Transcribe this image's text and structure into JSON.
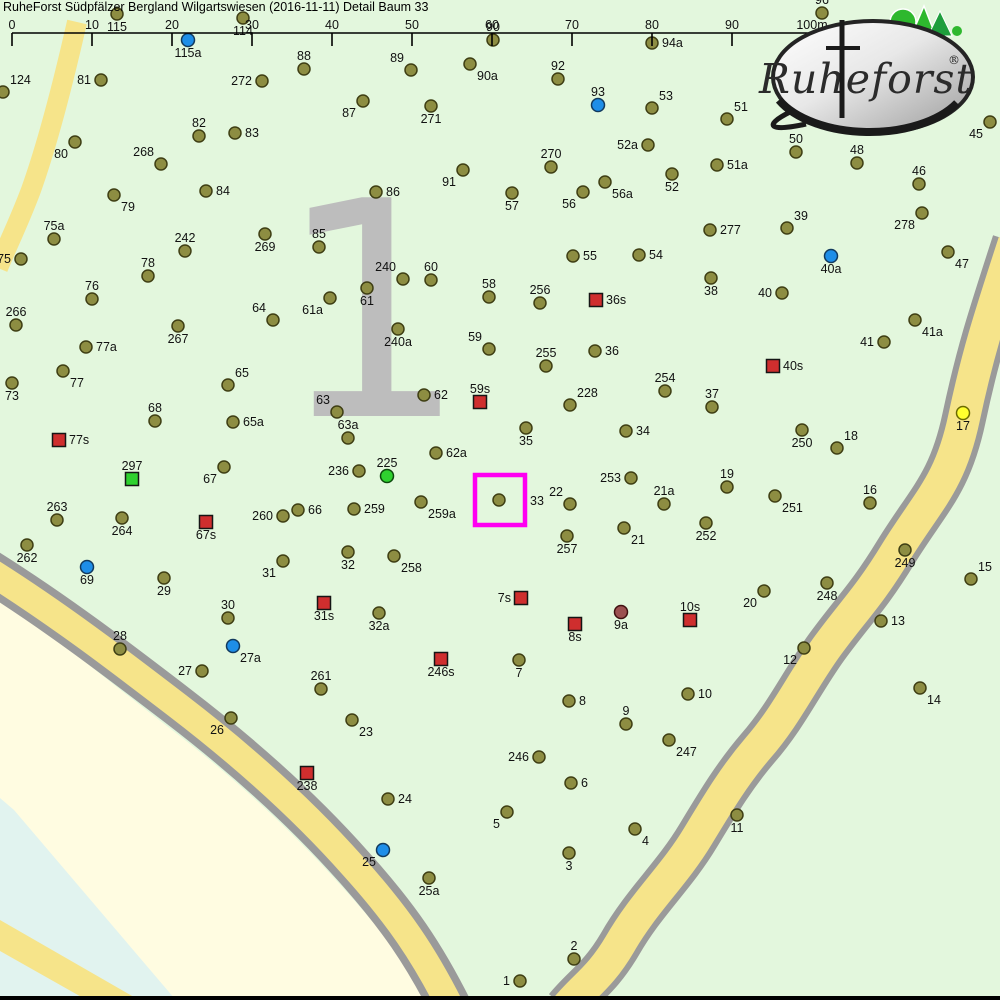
{
  "title": "RuheForst Südpfälzer Bergland Wilgartswiesen (2016-11-11) Detail  Baum 33",
  "logo": {
    "brand": "Ruheforst",
    "registered": "®"
  },
  "sector": {
    "label": "1"
  },
  "scale_bar": {
    "labels": [
      "0",
      "10",
      "20",
      "30",
      "40",
      "50",
      "60",
      "70",
      "80",
      "90",
      "100m"
    ],
    "tick_xs": [
      12,
      92,
      172,
      252,
      332,
      412,
      492,
      572,
      652,
      732,
      812
    ],
    "line_y": 33,
    "tick_bottom_y": 46,
    "label_y": 29
  },
  "highlight": {
    "for_point": "33",
    "x": 475,
    "y": 475,
    "size": 50,
    "color": "#ff00f2"
  },
  "colors": {
    "background": "#e3f7dd",
    "outside_area": "#fffce1",
    "water_band": "#e1f3ef",
    "road_fill": "#f6e48a",
    "road_border": "#9a9a9a",
    "sector_number": "#bdbdbd",
    "highlight": "#ff00f2",
    "tree": "#8d8d42",
    "tree_border": "#3f3f14",
    "blue": "#1e8ee8",
    "green": "#2fd12f",
    "yellow": "#ffff2e",
    "darkred": "#9c5050",
    "square_red": "#cf2e2e",
    "square_green": "#2fd12f",
    "label": "#111111"
  },
  "marker_kinds": {
    "t": "tree-olive-dot",
    "b": "blue-dot",
    "g": "green-dot",
    "y": "yellow-dot",
    "r": "darkred-dot",
    "sr": "red-square-marker",
    "sg": "green-square-marker"
  },
  "points": [
    {
      "n": "115",
      "x": 117,
      "y": 14,
      "k": "t",
      "p": "below"
    },
    {
      "n": "114",
      "x": 243,
      "y": 18,
      "k": "t",
      "p": "below"
    },
    {
      "n": "115a",
      "x": 188,
      "y": 40,
      "k": "b",
      "p": "below"
    },
    {
      "n": "96",
      "x": 822,
      "y": 13,
      "k": "t",
      "p": "above"
    },
    {
      "n": "94a",
      "x": 652,
      "y": 43,
      "k": "t",
      "p": "right"
    },
    {
      "n": "90",
      "x": 493,
      "y": 40,
      "k": "t",
      "p": "above"
    },
    {
      "n": "124",
      "x": 3,
      "y": 92,
      "k": "t",
      "p": "above-right"
    },
    {
      "n": "81",
      "x": 101,
      "y": 80,
      "k": "t",
      "p": "left"
    },
    {
      "n": "88",
      "x": 304,
      "y": 69,
      "k": "t",
      "p": "above"
    },
    {
      "n": "89",
      "x": 411,
      "y": 70,
      "k": "t",
      "p": "above-left"
    },
    {
      "n": "90a",
      "x": 470,
      "y": 64,
      "k": "t",
      "p": "below-right"
    },
    {
      "n": "272",
      "x": 262,
      "y": 81,
      "k": "t",
      "p": "left"
    },
    {
      "n": "92",
      "x": 558,
      "y": 79,
      "k": "t",
      "p": "above"
    },
    {
      "n": "93",
      "x": 598,
      "y": 105,
      "k": "b",
      "p": "above"
    },
    {
      "n": "53",
      "x": 652,
      "y": 108,
      "k": "t",
      "p": "above-right"
    },
    {
      "n": "51",
      "x": 727,
      "y": 119,
      "k": "t",
      "p": "above-right"
    },
    {
      "n": "82",
      "x": 199,
      "y": 136,
      "k": "t",
      "p": "above"
    },
    {
      "n": "83",
      "x": 235,
      "y": 133,
      "k": "t",
      "p": "right"
    },
    {
      "n": "80",
      "x": 75,
      "y": 142,
      "k": "t",
      "p": "below-left"
    },
    {
      "n": "268",
      "x": 161,
      "y": 164,
      "k": "t",
      "p": "above-left"
    },
    {
      "n": "87",
      "x": 363,
      "y": 101,
      "k": "t",
      "p": "below-left"
    },
    {
      "n": "271",
      "x": 431,
      "y": 106,
      "k": "t",
      "p": "below"
    },
    {
      "n": "270",
      "x": 551,
      "y": 167,
      "k": "t",
      "p": "above"
    },
    {
      "n": "52a",
      "x": 648,
      "y": 145,
      "k": "t",
      "p": "left"
    },
    {
      "n": "51a",
      "x": 717,
      "y": 165,
      "k": "t",
      "p": "right"
    },
    {
      "n": "52",
      "x": 672,
      "y": 174,
      "k": "t",
      "p": "below"
    },
    {
      "n": "45",
      "x": 990,
      "y": 122,
      "k": "t",
      "p": "below-left"
    },
    {
      "n": "50",
      "x": 796,
      "y": 152,
      "k": "t",
      "p": "above"
    },
    {
      "n": "48",
      "x": 857,
      "y": 163,
      "k": "t",
      "p": "above"
    },
    {
      "n": "46",
      "x": 919,
      "y": 184,
      "k": "t",
      "p": "above"
    },
    {
      "n": "84",
      "x": 206,
      "y": 191,
      "k": "t",
      "p": "right"
    },
    {
      "n": "79",
      "x": 114,
      "y": 195,
      "k": "t",
      "p": "below-right"
    },
    {
      "n": "91",
      "x": 463,
      "y": 170,
      "k": "t",
      "p": "below-left"
    },
    {
      "n": "86",
      "x": 376,
      "y": 192,
      "k": "t",
      "p": "right"
    },
    {
      "n": "56a",
      "x": 605,
      "y": 182,
      "k": "t",
      "p": "below-right"
    },
    {
      "n": "56",
      "x": 583,
      "y": 192,
      "k": "t",
      "p": "below-left"
    },
    {
      "n": "57",
      "x": 512,
      "y": 193,
      "k": "t",
      "p": "below"
    },
    {
      "n": "278",
      "x": 922,
      "y": 213,
      "k": "t",
      "p": "below-left"
    },
    {
      "n": "39",
      "x": 787,
      "y": 228,
      "k": "t",
      "p": "above-right"
    },
    {
      "n": "75a",
      "x": 54,
      "y": 239,
      "k": "t",
      "p": "above"
    },
    {
      "n": "242",
      "x": 185,
      "y": 251,
      "k": "t",
      "p": "above"
    },
    {
      "n": "85",
      "x": 319,
      "y": 247,
      "k": "t",
      "p": "above"
    },
    {
      "n": "269",
      "x": 265,
      "y": 234,
      "k": "t",
      "p": "below"
    },
    {
      "n": "75",
      "x": 21,
      "y": 259,
      "k": "t",
      "p": "left"
    },
    {
      "n": "277",
      "x": 710,
      "y": 230,
      "k": "t",
      "p": "right"
    },
    {
      "n": "55",
      "x": 573,
      "y": 256,
      "k": "t",
      "p": "right"
    },
    {
      "n": "54",
      "x": 639,
      "y": 255,
      "k": "t",
      "p": "right"
    },
    {
      "n": "47",
      "x": 948,
      "y": 252,
      "k": "t",
      "p": "below-right"
    },
    {
      "n": "40a",
      "x": 831,
      "y": 256,
      "k": "b",
      "p": "below"
    },
    {
      "n": "78",
      "x": 148,
      "y": 276,
      "k": "t",
      "p": "above"
    },
    {
      "n": "240",
      "x": 403,
      "y": 279,
      "k": "t",
      "p": "above-left"
    },
    {
      "n": "60",
      "x": 431,
      "y": 280,
      "k": "t",
      "p": "above"
    },
    {
      "n": "58",
      "x": 489,
      "y": 297,
      "k": "t",
      "p": "above"
    },
    {
      "n": "76",
      "x": 92,
      "y": 299,
      "k": "t",
      "p": "above"
    },
    {
      "n": "266",
      "x": 16,
      "y": 325,
      "k": "t",
      "p": "above"
    },
    {
      "n": "38",
      "x": 711,
      "y": 278,
      "k": "t",
      "p": "below"
    },
    {
      "n": "256",
      "x": 540,
      "y": 303,
      "k": "t",
      "p": "above"
    },
    {
      "n": "36s",
      "x": 596,
      "y": 300,
      "k": "sr",
      "p": "right"
    },
    {
      "n": "61",
      "x": 367,
      "y": 288,
      "k": "t",
      "p": "below"
    },
    {
      "n": "61a",
      "x": 330,
      "y": 298,
      "k": "t",
      "p": "below-left"
    },
    {
      "n": "64",
      "x": 273,
      "y": 320,
      "k": "t",
      "p": "above-left"
    },
    {
      "n": "40",
      "x": 782,
      "y": 293,
      "k": "t",
      "p": "left"
    },
    {
      "n": "267",
      "x": 178,
      "y": 326,
      "k": "t",
      "p": "below"
    },
    {
      "n": "77a",
      "x": 86,
      "y": 347,
      "k": "t",
      "p": "right"
    },
    {
      "n": "41a",
      "x": 915,
      "y": 320,
      "k": "t",
      "p": "below-right"
    },
    {
      "n": "41",
      "x": 884,
      "y": 342,
      "k": "t",
      "p": "left"
    },
    {
      "n": "240a",
      "x": 398,
      "y": 329,
      "k": "t",
      "p": "below"
    },
    {
      "n": "59",
      "x": 489,
      "y": 349,
      "k": "t",
      "p": "above-left"
    },
    {
      "n": "36",
      "x": 595,
      "y": 351,
      "k": "t",
      "p": "right"
    },
    {
      "n": "255",
      "x": 546,
      "y": 366,
      "k": "t",
      "p": "above"
    },
    {
      "n": "77",
      "x": 63,
      "y": 371,
      "k": "t",
      "p": "below-right"
    },
    {
      "n": "73",
      "x": 12,
      "y": 383,
      "k": "t",
      "p": "below"
    },
    {
      "n": "65",
      "x": 228,
      "y": 385,
      "k": "t",
      "p": "above-right"
    },
    {
      "n": "40s",
      "x": 773,
      "y": 366,
      "k": "sr",
      "p": "right"
    },
    {
      "n": "254",
      "x": 665,
      "y": 391,
      "k": "t",
      "p": "above"
    },
    {
      "n": "37",
      "x": 712,
      "y": 407,
      "k": "t",
      "p": "above"
    },
    {
      "n": "228",
      "x": 570,
      "y": 405,
      "k": "t",
      "p": "above-right"
    },
    {
      "n": "68",
      "x": 155,
      "y": 421,
      "k": "t",
      "p": "above"
    },
    {
      "n": "65a",
      "x": 233,
      "y": 422,
      "k": "t",
      "p": "right"
    },
    {
      "n": "62",
      "x": 424,
      "y": 395,
      "k": "t",
      "p": "right"
    },
    {
      "n": "59s",
      "x": 480,
      "y": 402,
      "k": "sr",
      "p": "above"
    },
    {
      "n": "63",
      "x": 337,
      "y": 412,
      "k": "t",
      "p": "above-left"
    },
    {
      "n": "17",
      "x": 963,
      "y": 413,
      "k": "y",
      "p": "below"
    },
    {
      "n": "63a",
      "x": 348,
      "y": 438,
      "k": "t",
      "p": "above"
    },
    {
      "n": "35",
      "x": 526,
      "y": 428,
      "k": "t",
      "p": "below"
    },
    {
      "n": "34",
      "x": 626,
      "y": 431,
      "k": "t",
      "p": "right"
    },
    {
      "n": "77s",
      "x": 59,
      "y": 440,
      "k": "sr",
      "p": "right"
    },
    {
      "n": "62a",
      "x": 436,
      "y": 453,
      "k": "t",
      "p": "right"
    },
    {
      "n": "250",
      "x": 802,
      "y": 430,
      "k": "t",
      "p": "below"
    },
    {
      "n": "18",
      "x": 837,
      "y": 448,
      "k": "t",
      "p": "above-right"
    },
    {
      "n": "297",
      "x": 132,
      "y": 479,
      "k": "sg",
      "p": "above"
    },
    {
      "n": "67",
      "x": 224,
      "y": 467,
      "k": "t",
      "p": "below-left"
    },
    {
      "n": "225",
      "x": 387,
      "y": 476,
      "k": "g",
      "p": "above"
    },
    {
      "n": "236",
      "x": 359,
      "y": 471,
      "k": "t",
      "p": "left"
    },
    {
      "n": "19",
      "x": 727,
      "y": 487,
      "k": "t",
      "p": "above"
    },
    {
      "n": "253",
      "x": 631,
      "y": 478,
      "k": "t",
      "p": "left"
    },
    {
      "n": "16",
      "x": 870,
      "y": 503,
      "k": "t",
      "p": "above"
    },
    {
      "n": "21a",
      "x": 664,
      "y": 504,
      "k": "t",
      "p": "above"
    },
    {
      "n": "33",
      "x": 499,
      "y": 500,
      "k": "t",
      "p": "right",
      "lx": 530,
      "ly": 505
    },
    {
      "n": "22",
      "x": 570,
      "y": 504,
      "k": "t",
      "p": "above-left"
    },
    {
      "n": "251",
      "x": 775,
      "y": 496,
      "k": "t",
      "p": "below-right"
    },
    {
      "n": "263",
      "x": 57,
      "y": 520,
      "k": "t",
      "p": "above"
    },
    {
      "n": "264",
      "x": 122,
      "y": 518,
      "k": "t",
      "p": "below"
    },
    {
      "n": "260",
      "x": 283,
      "y": 516,
      "k": "t",
      "p": "left"
    },
    {
      "n": "66",
      "x": 298,
      "y": 510,
      "k": "t",
      "p": "right"
    },
    {
      "n": "259",
      "x": 354,
      "y": 509,
      "k": "t",
      "p": "right"
    },
    {
      "n": "259a",
      "x": 421,
      "y": 502,
      "k": "t",
      "p": "below-right"
    },
    {
      "n": "67s",
      "x": 206,
      "y": 522,
      "k": "sr",
      "p": "below"
    },
    {
      "n": "21",
      "x": 624,
      "y": 528,
      "k": "t",
      "p": "below-right"
    },
    {
      "n": "252",
      "x": 706,
      "y": 523,
      "k": "t",
      "p": "below"
    },
    {
      "n": "257",
      "x": 567,
      "y": 536,
      "k": "t",
      "p": "below"
    },
    {
      "n": "31",
      "x": 283,
      "y": 561,
      "k": "t",
      "p": "below-left"
    },
    {
      "n": "32",
      "x": 348,
      "y": 552,
      "k": "t",
      "p": "below"
    },
    {
      "n": "258",
      "x": 394,
      "y": 556,
      "k": "t",
      "p": "below-right"
    },
    {
      "n": "262",
      "x": 27,
      "y": 545,
      "k": "t",
      "p": "below"
    },
    {
      "n": "69",
      "x": 87,
      "y": 567,
      "k": "b",
      "p": "below"
    },
    {
      "n": "29",
      "x": 164,
      "y": 578,
      "k": "t",
      "p": "below"
    },
    {
      "n": "249",
      "x": 905,
      "y": 550,
      "k": "t",
      "p": "below"
    },
    {
      "n": "15",
      "x": 971,
      "y": 579,
      "k": "t",
      "p": "above-right"
    },
    {
      "n": "248",
      "x": 827,
      "y": 583,
      "k": "t",
      "p": "below"
    },
    {
      "n": "20",
      "x": 764,
      "y": 591,
      "k": "t",
      "p": "below-left"
    },
    {
      "n": "30",
      "x": 228,
      "y": 618,
      "k": "t",
      "p": "above"
    },
    {
      "n": "7s",
      "x": 521,
      "y": 598,
      "k": "sr",
      "p": "left"
    },
    {
      "n": "31s",
      "x": 324,
      "y": 603,
      "k": "sr",
      "p": "below"
    },
    {
      "n": "32a",
      "x": 379,
      "y": 613,
      "k": "t",
      "p": "below"
    },
    {
      "n": "10s",
      "x": 690,
      "y": 620,
      "k": "sr",
      "p": "above"
    },
    {
      "n": "9a",
      "x": 621,
      "y": 612,
      "k": "r",
      "p": "below"
    },
    {
      "n": "8s",
      "x": 575,
      "y": 624,
      "k": "sr",
      "p": "below"
    },
    {
      "n": "13",
      "x": 881,
      "y": 621,
      "k": "t",
      "p": "right"
    },
    {
      "n": "28",
      "x": 120,
      "y": 649,
      "k": "t",
      "p": "above"
    },
    {
      "n": "27a",
      "x": 233,
      "y": 646,
      "k": "b",
      "p": "below-right"
    },
    {
      "n": "12",
      "x": 804,
      "y": 648,
      "k": "t",
      "p": "below-left"
    },
    {
      "n": "7",
      "x": 519,
      "y": 660,
      "k": "t",
      "p": "below"
    },
    {
      "n": "27",
      "x": 202,
      "y": 671,
      "k": "t",
      "p": "left"
    },
    {
      "n": "246s",
      "x": 441,
      "y": 659,
      "k": "sr",
      "p": "below"
    },
    {
      "n": "261",
      "x": 321,
      "y": 689,
      "k": "t",
      "p": "above"
    },
    {
      "n": "14",
      "x": 920,
      "y": 688,
      "k": "t",
      "p": "below-right"
    },
    {
      "n": "10",
      "x": 688,
      "y": 694,
      "k": "t",
      "p": "right"
    },
    {
      "n": "8",
      "x": 569,
      "y": 701,
      "k": "t",
      "p": "right"
    },
    {
      "n": "9",
      "x": 626,
      "y": 724,
      "k": "t",
      "p": "above"
    },
    {
      "n": "26",
      "x": 231,
      "y": 718,
      "k": "t",
      "p": "below-left"
    },
    {
      "n": "23",
      "x": 352,
      "y": 720,
      "k": "t",
      "p": "below-right"
    },
    {
      "n": "247",
      "x": 669,
      "y": 740,
      "k": "t",
      "p": "below-right"
    },
    {
      "n": "246",
      "x": 539,
      "y": 757,
      "k": "t",
      "p": "left"
    },
    {
      "n": "238",
      "x": 307,
      "y": 773,
      "k": "sr",
      "p": "below"
    },
    {
      "n": "6",
      "x": 571,
      "y": 783,
      "k": "t",
      "p": "right"
    },
    {
      "n": "24",
      "x": 388,
      "y": 799,
      "k": "t",
      "p": "right"
    },
    {
      "n": "5",
      "x": 507,
      "y": 812,
      "k": "t",
      "p": "below-left"
    },
    {
      "n": "25",
      "x": 383,
      "y": 850,
      "k": "b",
      "p": "below-left"
    },
    {
      "n": "25a",
      "x": 429,
      "y": 878,
      "k": "t",
      "p": "below"
    },
    {
      "n": "11",
      "x": 737,
      "y": 815,
      "k": "t",
      "p": "below"
    },
    {
      "n": "4",
      "x": 635,
      "y": 829,
      "k": "t",
      "p": "below-right"
    },
    {
      "n": "3",
      "x": 569,
      "y": 853,
      "k": "t",
      "p": "below"
    },
    {
      "n": "2",
      "x": 574,
      "y": 959,
      "k": "t",
      "p": "above"
    },
    {
      "n": "1",
      "x": 520,
      "y": 981,
      "k": "t",
      "p": "left"
    }
  ]
}
